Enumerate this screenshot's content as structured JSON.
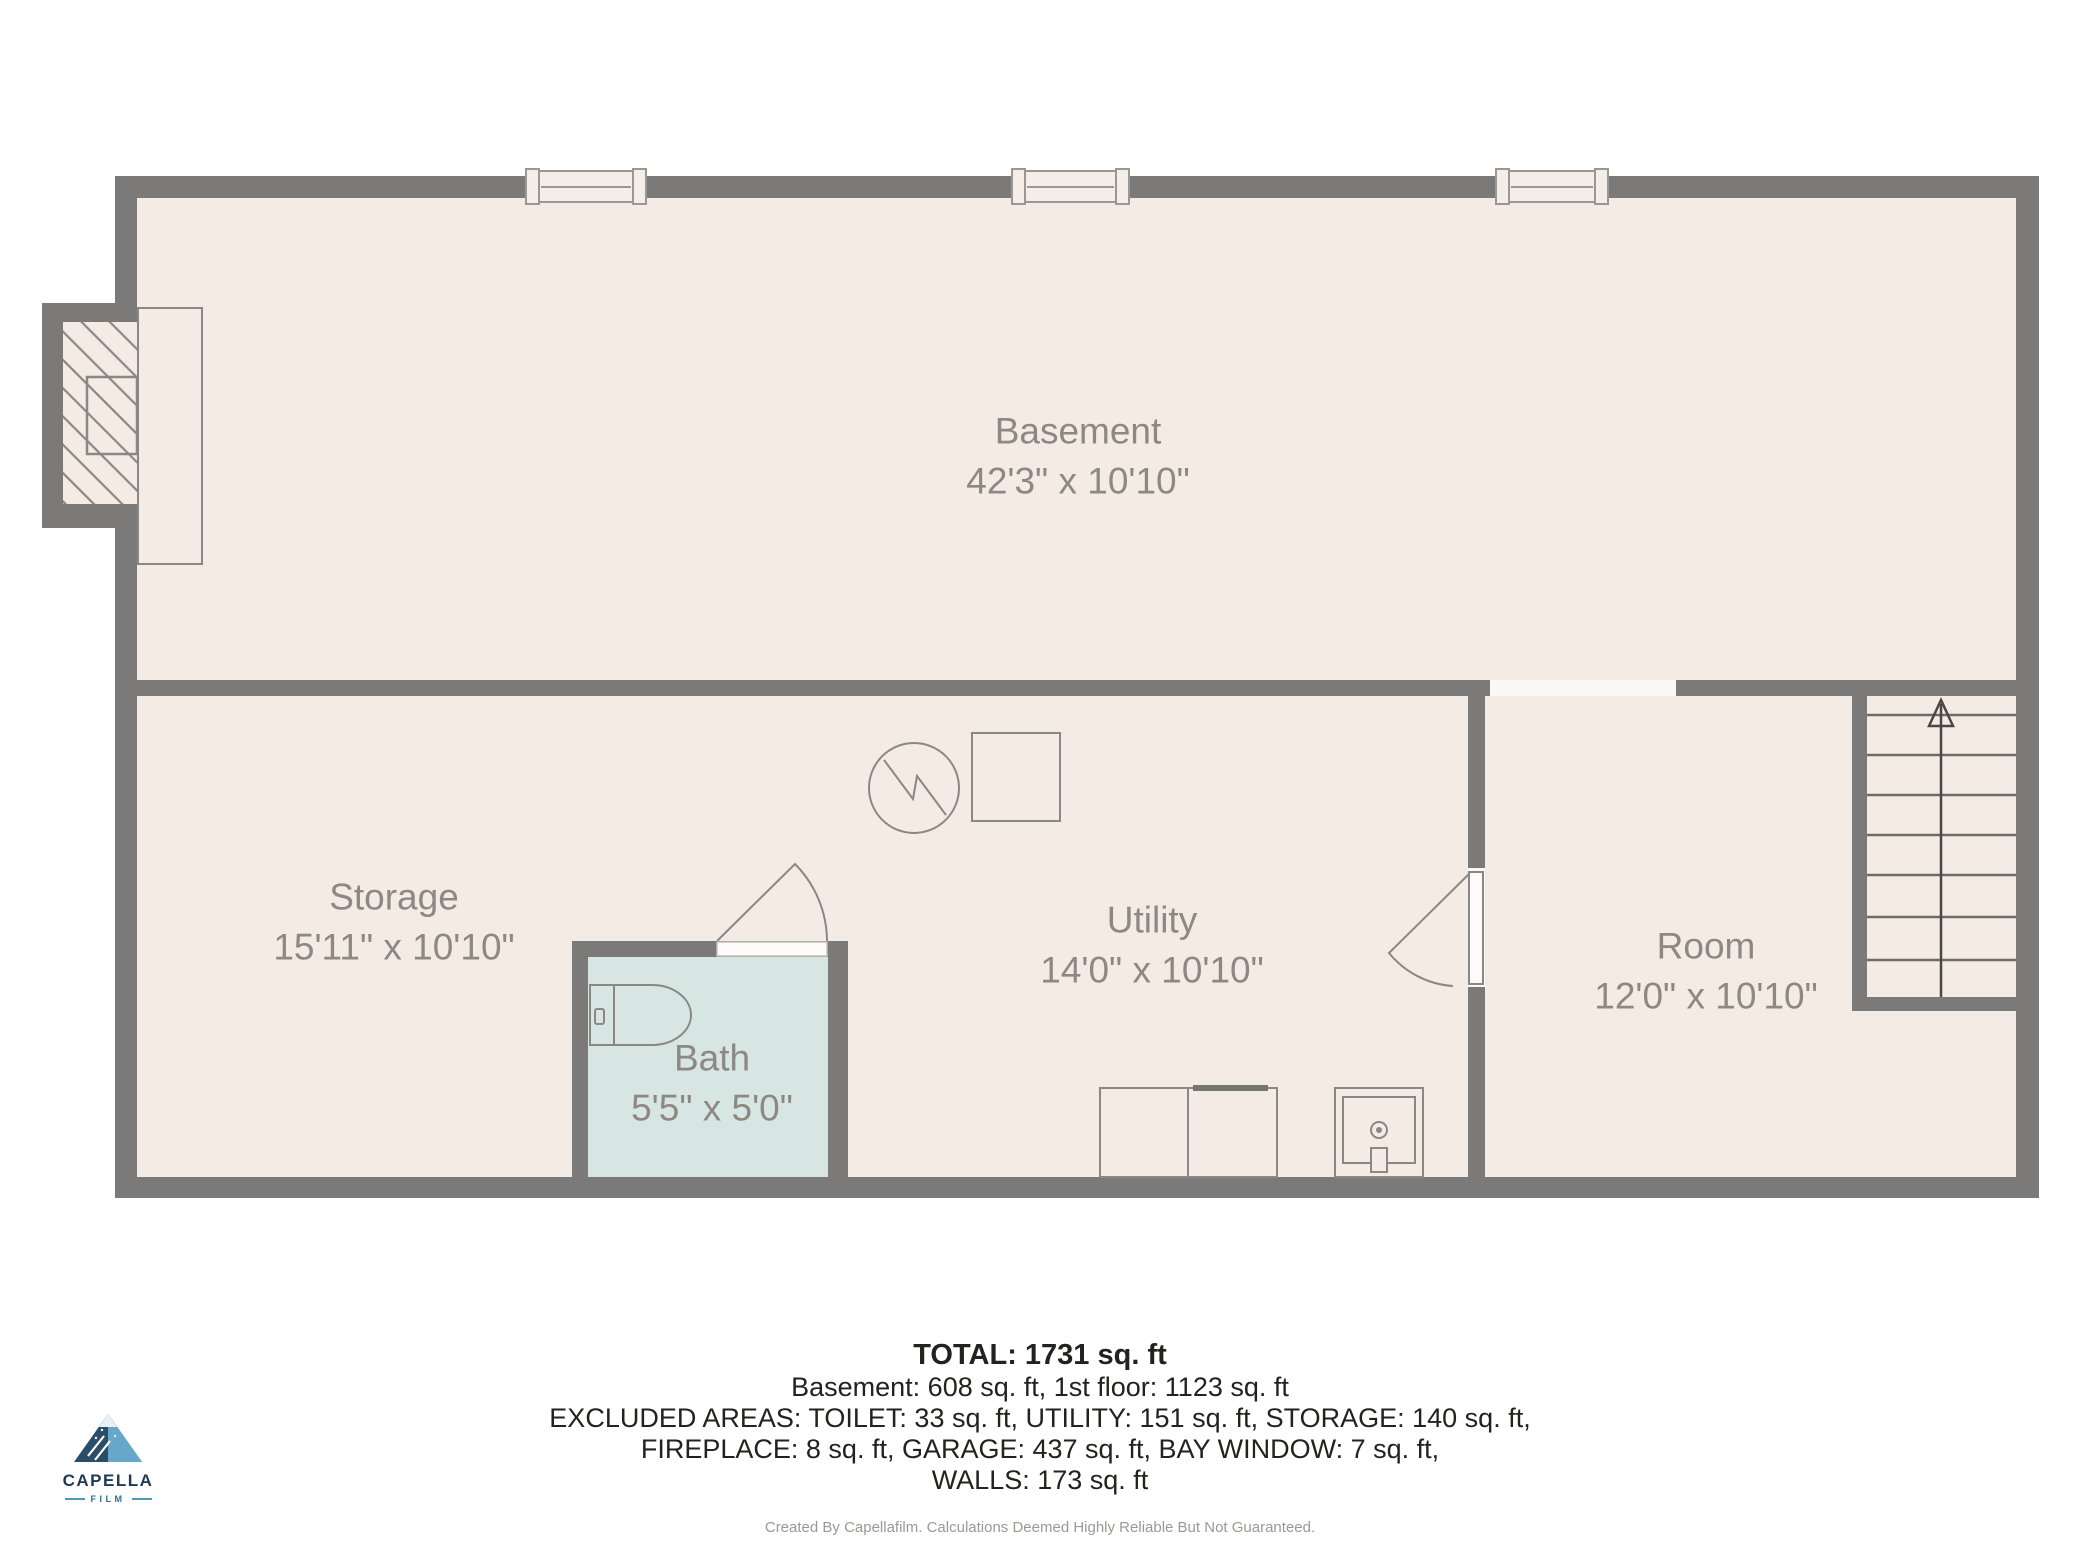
{
  "colors": {
    "wall": "#7b7a78",
    "floor": "#f4ebe5",
    "bathfloor": "#d7e5e3",
    "outline": "#8a8884",
    "text": "#8d8882",
    "footer-text": "#222220",
    "footer-note": "#9b9995",
    "logo-navy": "#1d3a52",
    "logo-teal": "#4a9cb5",
    "opening": "#fbf9f6"
  },
  "rooms": [
    {
      "id": "basement",
      "name": "Basement",
      "dims": "42'3\" x 10'10\""
    },
    {
      "id": "storage",
      "name": "Storage",
      "dims": "15'11\" x 10'10\""
    },
    {
      "id": "bath",
      "name": "Bath",
      "dims": "5'5\" x 5'0\""
    },
    {
      "id": "utility",
      "name": "Utility",
      "dims": "14'0\" x 10'10\""
    },
    {
      "id": "room",
      "name": "Room",
      "dims": "12'0\" x 10'10\""
    }
  ],
  "footer": {
    "total": "TOTAL: 1731 sq. ft",
    "line1": "Basement: 608 sq. ft, 1st floor: 1123 sq. ft",
    "line2": "EXCLUDED AREAS: TOILET: 33 sq. ft, UTILITY: 151 sq. ft, STORAGE: 140 sq. ft,",
    "line3": "FIREPLACE: 8 sq. ft, GARAGE: 437 sq. ft, BAY WINDOW: 7 sq. ft,",
    "line4": "WALLS: 173 sq. ft",
    "disclaimer": "Created By Capellafilm. Calculations Deemed Highly Reliable But Not Guaranteed."
  },
  "logo": {
    "name": "CAPELLA",
    "sub": "FILM"
  }
}
